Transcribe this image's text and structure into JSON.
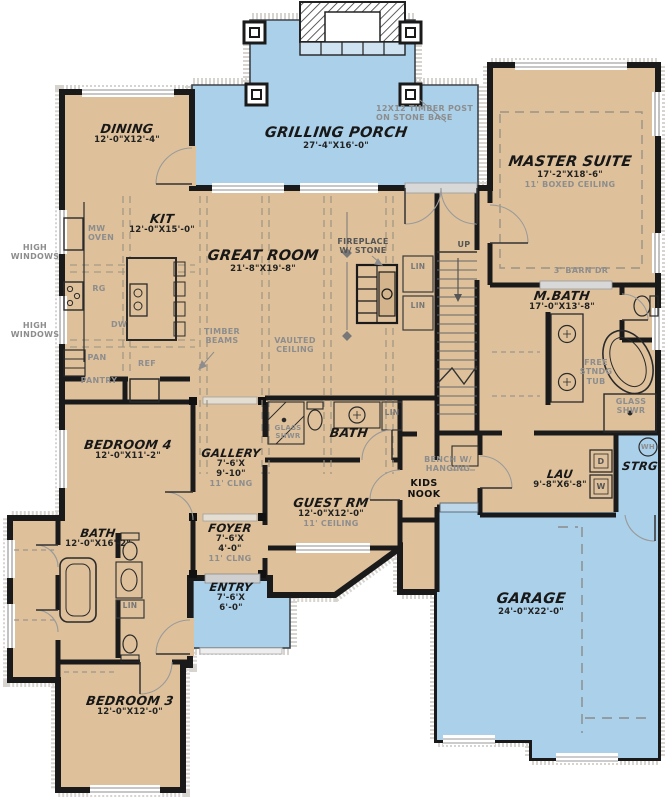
{
  "plan_title": "First Floor Plan",
  "colors": {
    "floor": "#dec19b",
    "porch_blue": "#abd0e9",
    "wall": "#1a1a1a",
    "annotation_gray": "#8d8d8d"
  },
  "rooms": {
    "dining": {
      "name": "DINING",
      "dims": "12'-0\"X12'-4\""
    },
    "grilling_porch": {
      "name": "GRILLING PORCH",
      "dims": "27'-4\"X16'-0\""
    },
    "master_suite": {
      "name": "MASTER SUITE",
      "dims": "17'-2\"X18'-6\"",
      "ceiling": "11' BOXED CEILING"
    },
    "kitchen": {
      "name": "KIT",
      "dims": "12'-0\"X15'-0\""
    },
    "great_room": {
      "name": "GREAT ROOM",
      "dims": "21'-8\"X19'-8\""
    },
    "master_bath": {
      "name": "M.BATH",
      "dims": "17'-0\"X13'-8\""
    },
    "bedroom4": {
      "name": "BEDROOM 4",
      "dims": "12'-0\"X11'-2\""
    },
    "gallery": {
      "name": "GALLERY",
      "width": "7'-6'X",
      "length": "9'-10\"",
      "ceiling": "11' CLNG"
    },
    "bath_center": {
      "name": "BATH"
    },
    "guest_room": {
      "name": "GUEST RM",
      "dims": "12'-0\"X12'-0\"",
      "ceiling": "11' CEILING"
    },
    "laundry": {
      "name": "LAU",
      "dims": "9'-8\"X6'-8\""
    },
    "storage": {
      "name": "STRG"
    },
    "garage": {
      "name": "GARAGE",
      "dims": "24'-0\"X22'-0\""
    },
    "bath_left": {
      "name": "BATH",
      "dims": "12'-0\"X16'-2\""
    },
    "foyer": {
      "name": "FOYER",
      "width": "7'-6'X",
      "length": "4'-0\"",
      "ceiling": "11' CLNG"
    },
    "entry": {
      "name": "ENTRY",
      "width": "7'-6'X",
      "length": "6'-0\""
    },
    "bedroom3": {
      "name": "BEDROOM 3",
      "dims": "12'-0\"X12'-0\""
    }
  },
  "annotations": {
    "timber_post": "12X12 TIMBER POST\nON STONE BASE",
    "high_windows": "HIGH\nWINDOWS",
    "fireplace": "FIREPLACE\nW/ STONE",
    "timber_beams": "TIMBER\nBEAMS",
    "vaulted_ceiling": "VAULTED\nCEILING",
    "barn_door": "3' BARN DR",
    "up": "UP",
    "lin": "LIN",
    "free_tub": "FREE\nSTNDG\nTUB",
    "glass_shower": "GLASS\nSHWR",
    "bench": "BENCH W/\nHANGING",
    "kids_nook": "KIDS\nNOOK",
    "microwave": "MW\nOVEN",
    "range": "RG",
    "dishwasher": "DW",
    "pan": "PAN",
    "pantry": "PANTRY",
    "refrigerator": "REF",
    "dryer": "D",
    "washer": "W",
    "water_heater": "WH"
  }
}
